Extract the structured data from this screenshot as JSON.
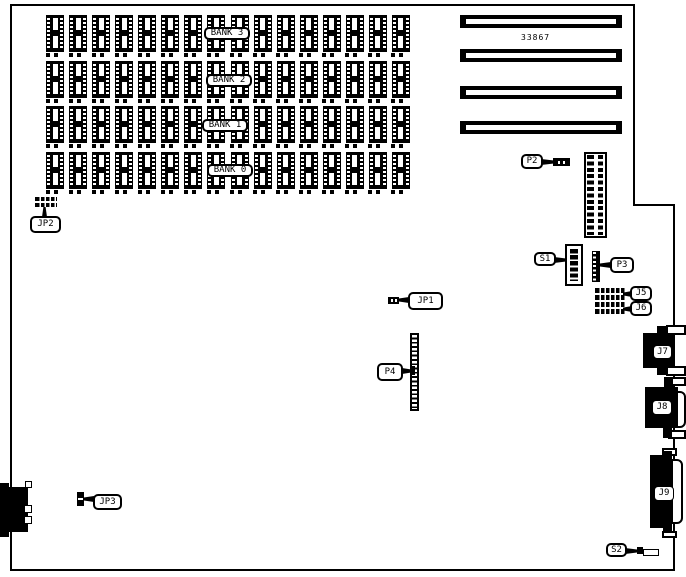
{
  "diagram": {
    "part_number": "33867",
    "banks": [
      "BANK 3",
      "BANK 2",
      "BANK 1",
      "BANK 0"
    ],
    "chips_per_bank": 16,
    "bank_row_pitch": 45.7,
    "slot_count": 4,
    "slot_tops": [
      0,
      34,
      71,
      106
    ],
    "labels": {
      "jp1": "JP1",
      "jp2": "JP2",
      "jp3": "JP3",
      "p2": "P2",
      "p3": "P3",
      "p4": "P4",
      "s1": "S1",
      "s2": "S2",
      "j5": "J5",
      "j6": "J6",
      "j7": "J7",
      "j8": "J8",
      "j9": "J9"
    },
    "colors": {
      "ink": "#000000",
      "paper": "#ffffff"
    }
  }
}
